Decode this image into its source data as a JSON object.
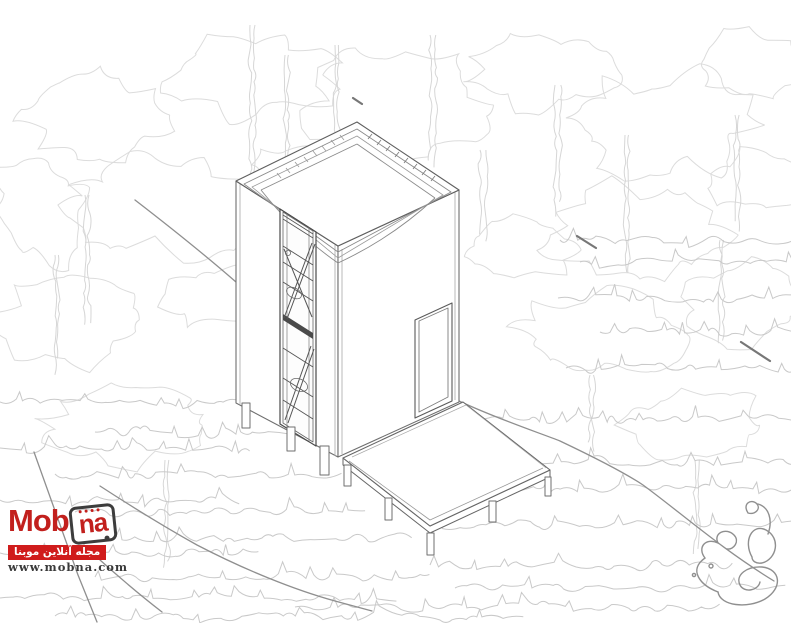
{
  "scene": {
    "drawing": "axonometric-cabin-line-drawing",
    "background": "forest-sketch",
    "signature_icon": "persian-calligraphy-signature"
  },
  "watermark": {
    "brand_prefix": "Mob",
    "brand_suffix": "na",
    "banner_text": "مجله آنلاین موبنا",
    "url": "www.mobna.com",
    "brand_color": "#c2201d",
    "banner_bg": "#d01c1c",
    "url_color": "#3a3a3a",
    "tablet_icon": "tablet-icon"
  },
  "palette": {
    "building_line": "#6f6f6f",
    "detail_line": "#4a4a4a",
    "terrain_line": "#8f8f8f",
    "forest_line": "#dcdcdc",
    "grass_line": "#c9c9c9",
    "paper": "#ffffff"
  }
}
